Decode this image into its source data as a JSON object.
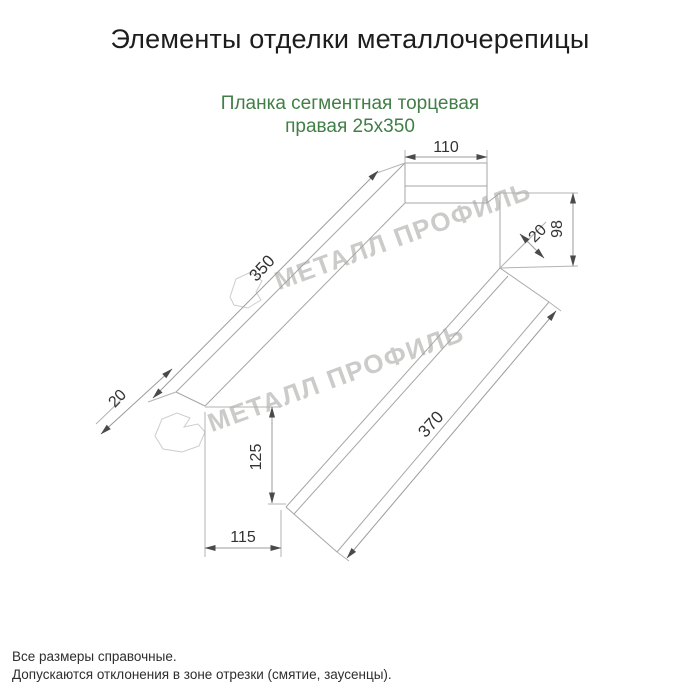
{
  "page": {
    "title": "Элементы отделки металлочерепицы",
    "subtitle_line1": "Планка сегментная торцевая",
    "subtitle_line2": "правая 25х350",
    "subtitle_color": "#417f47"
  },
  "watermark": {
    "text": "МЕТАЛЛ ПРОФИЛЬ",
    "color": "#cbcbc9"
  },
  "drawing": {
    "type": "isometric technical drawing of right segmental end cap 25x350",
    "line_color": "#a6a6a6",
    "dims": {
      "top_width": "110",
      "right_height": "98",
      "right_hem": "20",
      "length_top": "350",
      "left_hem": "20",
      "length_bottom": "370",
      "bottom_height": "125",
      "bottom_width": "115"
    }
  },
  "footer": {
    "line1": "Все размеры справочные.",
    "line2": "Допускаются отклонения в зоне отрезки (смятие, заусенцы)."
  }
}
